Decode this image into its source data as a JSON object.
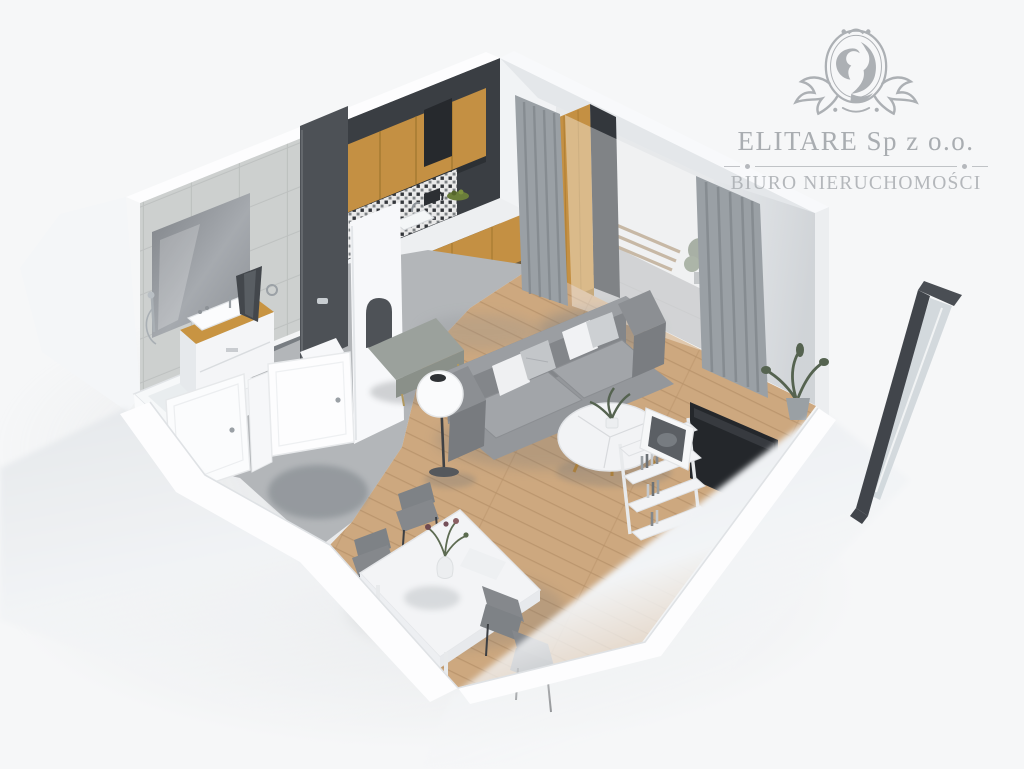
{
  "watermark": {
    "icon": "lion-crest-icon",
    "company": "ELITARE Sp z o.o.",
    "tagline": "BIURO NIERUCHOMOŚCI"
  },
  "colors": {
    "background": "#f6f7f8",
    "wall_white": "#fdfdfe",
    "wall_light": "#eef0f2",
    "wall_gray": "#e4e7ea",
    "tile": "#d7d9d8",
    "tile_line": "#c6c9c8",
    "kitchen_dark_wall": "#3a3e43",
    "cabinet_wood": "#c49043",
    "cabinet_wood_dark": "#a5772e",
    "wood_floor": "#c9a175",
    "wood_floor_line": "#b28a5d",
    "concrete_floor": "#b3b6b9",
    "bathroom_floor": "#787d82",
    "sofa_gray": "#8f9296",
    "sofa_light": "#a5a8ac",
    "curtain_gray": "#9aa0a5",
    "charcoal": "#4a4e53",
    "white_furniture": "#f3f4f6",
    "chair_gray": "#85888c",
    "plant_green": "#556350",
    "balcony_floor": "#a7aaac",
    "glass": "#ccd3d8",
    "logo_gray": "#a9adb1"
  }
}
